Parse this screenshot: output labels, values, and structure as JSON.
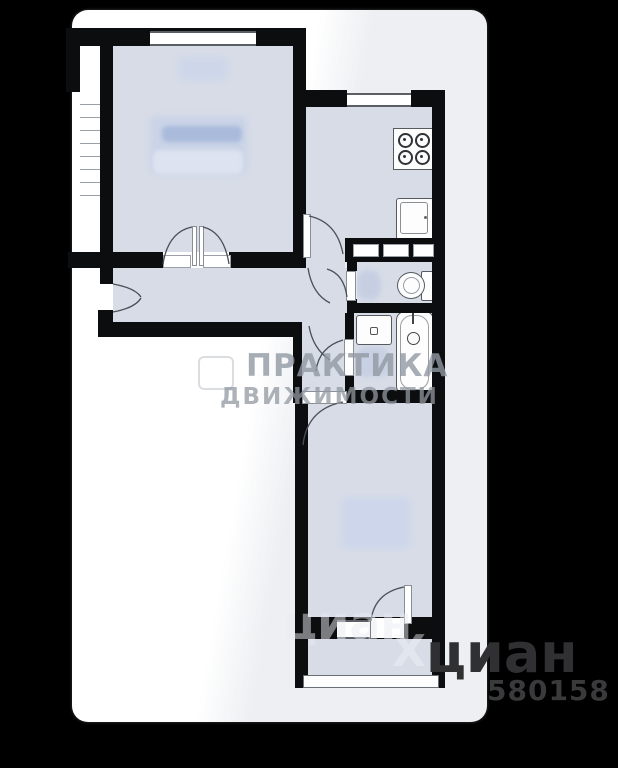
{
  "scene": {
    "type": "apartment-floor-plan"
  },
  "colors": {
    "background": "#000000",
    "canvas": "#ffffff",
    "canvas_tint": "#edeff2",
    "wall": "#0c0d0f",
    "room_fill": "#d7dce7",
    "furniture_blob": "#c9d3e8",
    "door_arc": "#4a4f57",
    "watermark_gray": "#9198a2",
    "watermark_dark": "#303032"
  },
  "watermarks": {
    "agency_line1": "ПРАКТИКА",
    "agency_line2": "ДВИЖИМОСТИ",
    "cian_light": "циан",
    "cian_x": "Х",
    "cian_dark": "циан",
    "listing_number": "580158"
  },
  "rooms": [
    {
      "name": "living-room"
    },
    {
      "name": "kitchen"
    },
    {
      "name": "hallway"
    },
    {
      "name": "corridor"
    },
    {
      "name": "wc"
    },
    {
      "name": "bathroom"
    },
    {
      "name": "bedroom"
    },
    {
      "name": "balcony"
    }
  ],
  "fixtures": [
    {
      "icon": "stove-icon"
    },
    {
      "icon": "kitchen-sink-icon"
    },
    {
      "icon": "toilet-icon"
    },
    {
      "icon": "bathroom-sink-icon"
    },
    {
      "icon": "bathtub-icon"
    }
  ]
}
